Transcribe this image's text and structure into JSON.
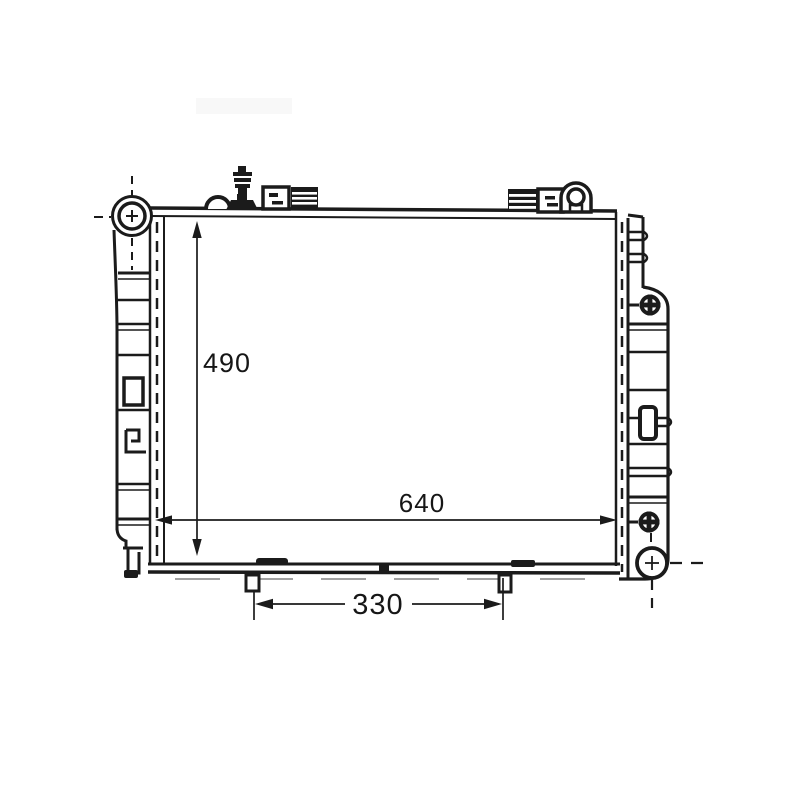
{
  "colors": {
    "background": "#ffffff",
    "ink": "#1b1b1b"
  },
  "dimensions": {
    "height": "490",
    "width": "640",
    "bottom_span": "330"
  }
}
